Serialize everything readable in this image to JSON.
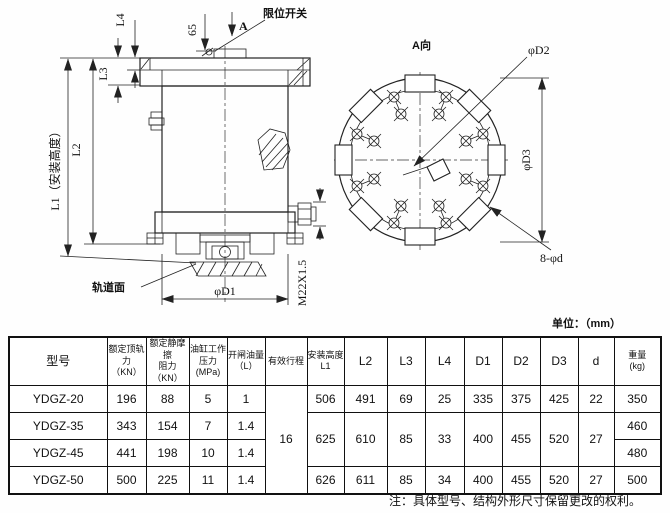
{
  "page": {
    "units_label": "单位：（mm）",
    "note": "注：具体型号、结构外形尺寸保留更改的权利。"
  },
  "drawing": {
    "side_view": {
      "dim_l1": "L1（安装高度）",
      "dim_l2": "L2",
      "dim_l3": "L3",
      "dim_l4": "L4",
      "dim_65": "65",
      "section_label": "A",
      "limit_switch_label": "限位开关",
      "rail_surface_label": "轨道面",
      "dim_d1": "φD1",
      "thread_label": "M22X1.5"
    },
    "a_view": {
      "title": "A向",
      "dim_d2": "φD2",
      "dim_d3": "φD3",
      "bolt_label": "8-φd"
    }
  },
  "table": {
    "headers": {
      "model": "型号",
      "rated_rail_force": "额定顶轨力\n（KN）",
      "rated_static_friction": "额定静摩擦\n阻力\n（KN）",
      "cylinder_pressure": "油缸工作\n压力(MPa)",
      "open_oil_volume": "开闸油量\n（L）",
      "effective_stroke": "有效行程",
      "install_height": "安装高度\nL1",
      "l2": "L2",
      "l3": "L3",
      "l4": "L4",
      "d1": "D1",
      "d2": "D2",
      "d3": "D3",
      "d": "d",
      "weight": "重量\n(kg)"
    },
    "shared": {
      "effective_stroke": "16"
    },
    "mid_group": {
      "l1": "625",
      "l2": "610",
      "l3": "85",
      "l4": "33",
      "d1": "400",
      "d2": "455",
      "d3": "520",
      "d": "27"
    },
    "rows": [
      {
        "model": "YDGZ-20",
        "force": "196",
        "friction": "88",
        "pressure": "5",
        "oil": "1",
        "l1": "506",
        "l2": "491",
        "l3": "69",
        "l4": "25",
        "d1": "335",
        "d2": "375",
        "d3": "425",
        "d": "22",
        "weight": "350"
      },
      {
        "model": "YDGZ-35",
        "force": "343",
        "friction": "154",
        "pressure": "7",
        "oil": "1.4",
        "weight": "460"
      },
      {
        "model": "YDGZ-45",
        "force": "441",
        "friction": "198",
        "pressure": "10",
        "oil": "1.4",
        "weight": "480"
      },
      {
        "model": "YDGZ-50",
        "force": "500",
        "friction": "225",
        "pressure": "11",
        "oil": "1.4",
        "l1": "626",
        "l2": "611",
        "l3": "85",
        "l4": "34",
        "d1": "400",
        "d2": "455",
        "d3": "520",
        "d": "27",
        "weight": "500"
      }
    ]
  }
}
